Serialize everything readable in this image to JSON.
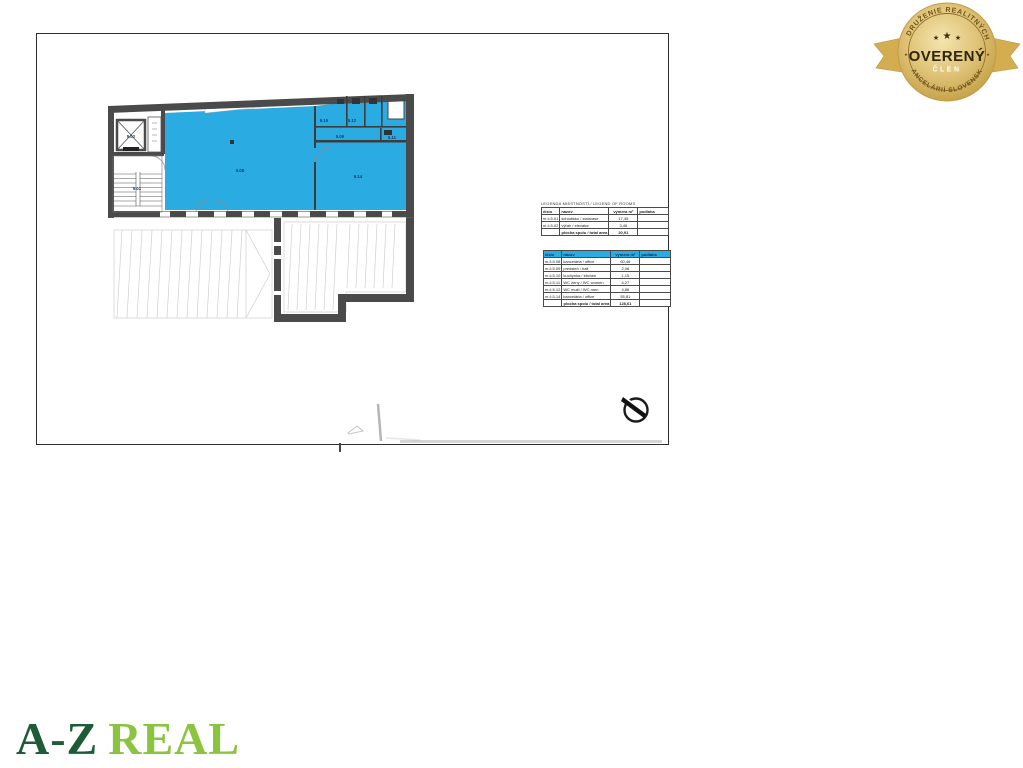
{
  "floor_plan": {
    "rooms": {
      "r501": "5.01",
      "r502": "5.02",
      "r508": "5.08",
      "r509": "5.09",
      "r510": "5.10",
      "r511": "5.11",
      "r512": "5.12",
      "r514": "5.14"
    },
    "highlight_color": "#2aace3",
    "wall_color": "#4a4a4a"
  },
  "legend_rooms_table": {
    "title": "LEGENDA MIESTNOSTÍ / LEGEND OF ROOMS",
    "headers": [
      "číslo",
      "názov",
      "výmera m²",
      "podlaha"
    ],
    "rows": [
      {
        "no": "m.č.5.01",
        "name": "schodisko / staircase",
        "area": "17,45",
        "floor": ""
      },
      {
        "no": "m.č.5.02",
        "name": "výťah / elevator",
        "area": "3,46",
        "floor": ""
      }
    ],
    "footer": {
      "label": "plocha spolu / total area",
      "value": "20,91"
    }
  },
  "unit_rooms_table": {
    "headers": [
      "číslo",
      "názov",
      "výmera m²",
      "podlaha"
    ],
    "header_color": "#2aace3",
    "rows": [
      {
        "no": "m.č.5.08",
        "name": "kancelária / office",
        "area": "60,46",
        "floor": ""
      },
      {
        "no": "m.č.5.09",
        "name": "predsieň / hall",
        "area": "2,06",
        "floor": ""
      },
      {
        "no": "m.č.5.10",
        "name": "kuchynka / kitchen",
        "area": "1,15",
        "floor": ""
      },
      {
        "no": "m.č.5.11",
        "name": "WC ženy / WC women",
        "area": "4,27",
        "floor": ""
      },
      {
        "no": "m.č.5.12",
        "name": "WC muži / WC men",
        "area": "4,86",
        "floor": ""
      },
      {
        "no": "m.č.5.14",
        "name": "kancelária / office",
        "area": "55,81",
        "floor": ""
      }
    ],
    "footer": {
      "label": "plocha spolu / total area",
      "value": "128,61"
    }
  },
  "badge": {
    "top_arc": "ZDRUŽENIE REALITNÝCH",
    "title": "OVERENÝ",
    "subtitle": "ČLEN",
    "bottom_arc": "KANCELÁRIÍ SLOVENSKA",
    "stars": {
      "left": "★",
      "center": "★",
      "right": "★",
      "side_left": "★",
      "side_right": "★"
    },
    "gold_color": "#d9b55f",
    "text_color": "#3a2d0b"
  },
  "logo": {
    "primary": "A-Z",
    "secondary": "REAL",
    "primary_color": "#1d5c36",
    "secondary_color": "#8bc53f"
  }
}
